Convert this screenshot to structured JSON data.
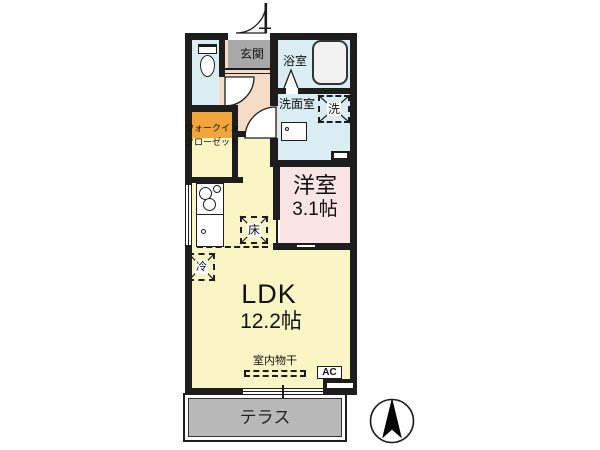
{
  "rooms": {
    "entrance": {
      "label": "玄関"
    },
    "bathroom": {
      "label": "浴室"
    },
    "washroom": {
      "label": "洗面室"
    },
    "washer_box": {
      "label": "洗"
    },
    "walk_in_closet": {
      "line1": "ウォークイン",
      "line2": "クローゼット"
    },
    "western_room": {
      "name": "洋室",
      "size": "3.1帖"
    },
    "ldk": {
      "name": "LDK",
      "size": "12.2帖"
    },
    "refrigerator_box": {
      "label": "冷"
    },
    "floor_storage_box": {
      "label": "床"
    },
    "terrace": {
      "label": "テラス"
    }
  },
  "annotations": {
    "indoor_drying": {
      "label": "室内物干"
    },
    "air_conditioner": {
      "label": "AC"
    }
  },
  "icons": {
    "compass": "north-arrow"
  },
  "colors": {
    "wall": "#1d1d1d",
    "wet_rooms": "#d9edf2",
    "entrance_tile": "#a8a8a8",
    "hallway": "#f5dcc6",
    "walk_in_closet": "#f0a63a",
    "western_room": "#f9e4e6",
    "ldk": "#faf5c5",
    "terrace": "#b9b9b9"
  }
}
